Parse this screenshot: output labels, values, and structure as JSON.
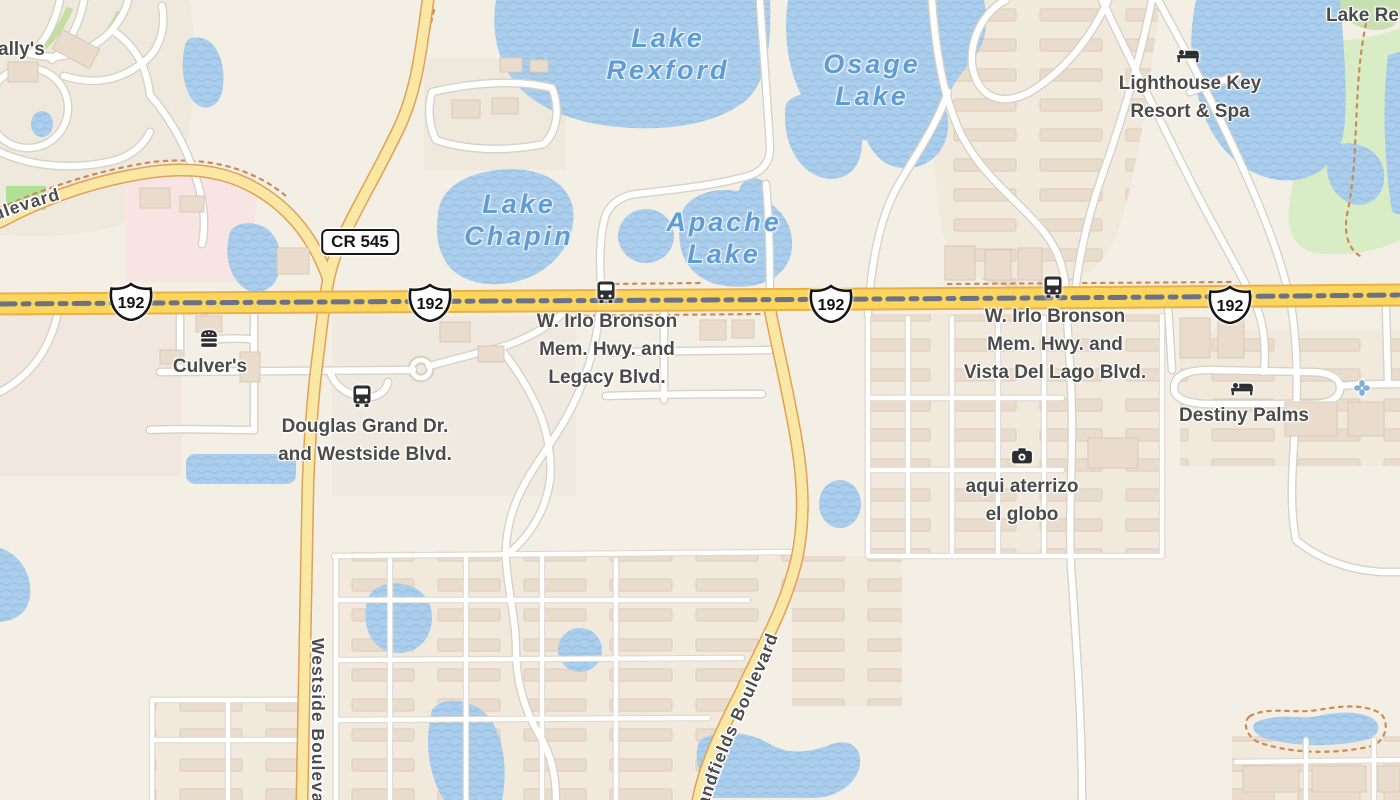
{
  "map": {
    "kind": "street-map",
    "colors": {
      "land": "#f4efe4",
      "water": "#abceec",
      "water_wave": "#9dc3e5",
      "water_label": "#5f9cd4",
      "residential": "#f0e9dc",
      "pink_area": "#f7e4e3",
      "green_area": "#d8ecc6",
      "road_primary": "#fcd55d",
      "road_primary_casing": "#e9af4a",
      "road_secondary": "#fbe7a4",
      "road_secondary_casing": "#dfa156",
      "road_minor": "#ffffff",
      "median_dash": "#6b7286",
      "trail_dotted": "#cd8b52",
      "poi_label": "#4b4b4b",
      "icon_dark": "#2d2d32",
      "icon_blue": "#7fafd9"
    }
  },
  "roads": {
    "us_192_shield": "192",
    "cr_545_shield": "CR 545",
    "westside_boulevard": "Westside Boulevard",
    "boulevard_partial": "Boulevard",
    "sandfields_boulevard": "Sandfields Boulevard"
  },
  "lakes": {
    "rexford": {
      "line1": "Lake",
      "line2": "Rexford"
    },
    "osage": {
      "line1": "Osage",
      "line2": "Lake"
    },
    "chapin": {
      "line1": "Lake",
      "line2": "Chapin"
    },
    "apache": {
      "line1": "Apache",
      "line2": "Lake"
    }
  },
  "pois": {
    "ballys": {
      "name": "ally's"
    },
    "culvers": {
      "name": "Culver's",
      "icon": "burger-icon"
    },
    "lighthouse": {
      "line1": "Lighthouse Key",
      "line2": "Resort & Spa",
      "icon": "bed-icon"
    },
    "destiny": {
      "name": "Destiny Palms",
      "icon": "bed-icon"
    },
    "globo": {
      "line1": "aqui aterrizo",
      "line2": "el globo",
      "icon": "camera-icon"
    },
    "lake_re": {
      "name": "Lake Re"
    },
    "attraction": {
      "icon": "fan-icon"
    }
  },
  "intersections": {
    "irlo_legacy": {
      "line1": "W. Irlo Bronson",
      "line2": "Mem. Hwy. and",
      "line3": "Legacy Blvd."
    },
    "irlo_vista": {
      "line1": "W. Irlo Bronson",
      "line2": "Mem. Hwy. and",
      "line3": "Vista Del Lago Blvd."
    },
    "douglas": {
      "line1": "Douglas Grand Dr.",
      "line2": "and Westside Blvd."
    }
  },
  "transit": {
    "bus_stop_icon": "bus-icon"
  }
}
